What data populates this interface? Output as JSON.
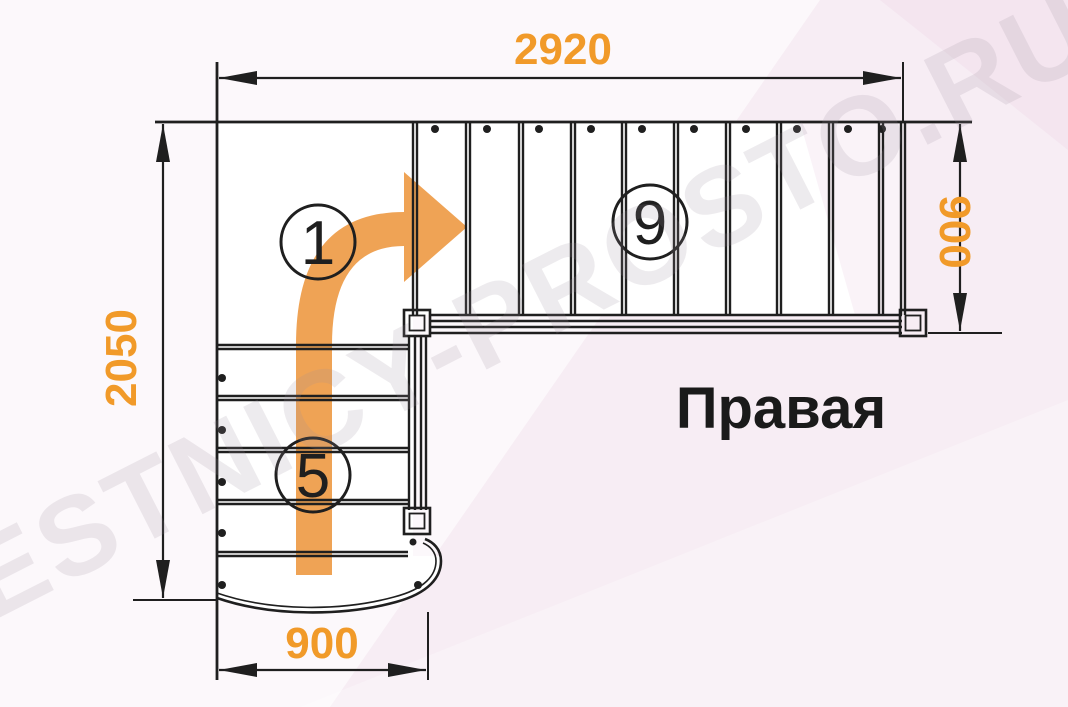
{
  "diagram": {
    "orientation_label": "Правая",
    "watermark": "LESTNICY-PROSTO.RU",
    "dimensions": {
      "top_width": "2920",
      "left_height": "2050",
      "right_height": "900",
      "bottom_width": "900"
    },
    "step_markers": [
      {
        "value": "1"
      },
      {
        "value": "5"
      },
      {
        "value": "9"
      }
    ],
    "upper_flight_tread_lines": 10,
    "lower_flight_tread_lines": 5,
    "colors": {
      "dimension_text": "#F19A29",
      "direction_arrow": "#EFA355",
      "linework": "#1F1F1F",
      "background": "#F7EDF4",
      "watermark": "#9B8F9D"
    }
  }
}
